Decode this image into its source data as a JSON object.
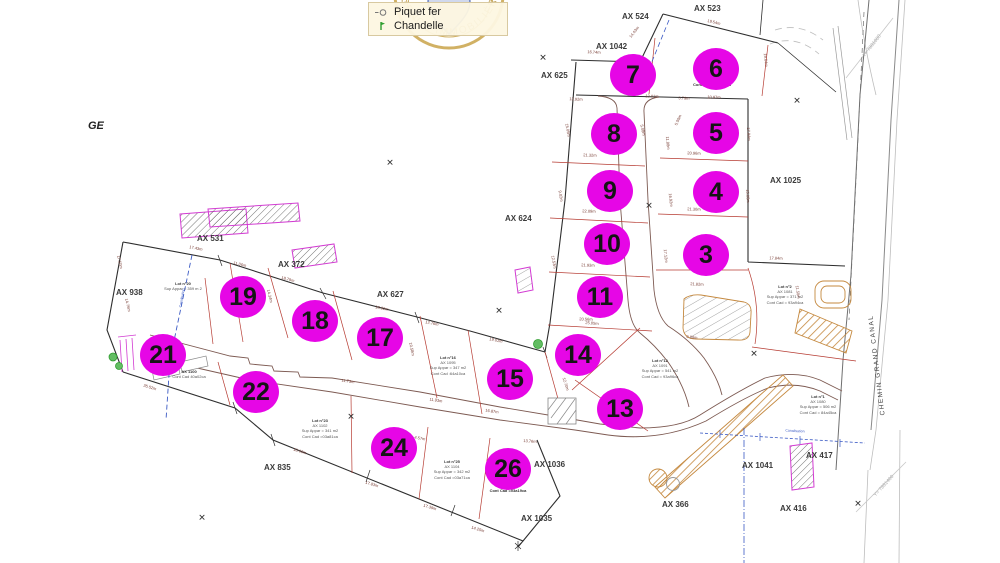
{
  "legend": {
    "items": [
      {
        "icon": "survey-marker-icon",
        "label": "Piquet fer"
      },
      {
        "icon": "pin-icon",
        "label": "Chandelle"
      }
    ]
  },
  "stamp": {
    "text": "AGENCE IMMOBILIÈRE"
  },
  "map": {
    "zone_label": "GE",
    "road_name": "CHEMIN GRAND CANAL",
    "grid_labels": [
      "Y= 7881000",
      "Y= 7881400"
    ],
    "pipe_label": "Canalisation",
    "x_mark": "✕"
  },
  "colors": {
    "lot_marker": "#e606e6",
    "boundary": "#2e2e2e",
    "division": "#b63b32",
    "sidewalk_hatch": "#c5893f",
    "pipe_blue": "#3b5ac4",
    "tree_green": "#2f9e2f"
  },
  "parcel_labels": [
    "AX 524",
    "AX 523",
    "AX 1042",
    "AX 625",
    "AX 624",
    "AX 1025",
    "AX 531",
    "AX 372",
    "AX 938",
    "AX 627",
    "AX 835",
    "AX 1036",
    "AX 1035",
    "AX 366",
    "AX 416",
    "AX 1041",
    "AX 417"
  ],
  "lot_badges": [
    "7",
    "6",
    "8",
    "5",
    "9",
    "4",
    "10",
    "3",
    "11",
    "14",
    "15",
    "13",
    "17",
    "18",
    "19",
    "21",
    "22",
    "24",
    "26"
  ],
  "lot_notes": [
    {
      "lines": [
        "Lot n°20",
        "Sup Appar = 359 m 2"
      ]
    },
    {
      "lines": [
        "AX 1100",
        "Cont Cad 40a02ca"
      ]
    },
    {
      "lines": [
        "Lot n°16",
        "AX 1095",
        "Sup Appar = 347 m2",
        "Cont Cad :64a10ca"
      ]
    },
    {
      "lines": [
        "Lot n°12",
        "AX 1091",
        "Sup Appar = 541 m2",
        "Cont Cad = 93a96ca"
      ]
    },
    {
      "lines": [
        "Lot n°2",
        "AX 1081",
        "Sup Appar = 371 m2",
        "Cont Cad = 93a94ca"
      ]
    },
    {
      "lines": [
        "Lot n°1",
        "AX 1080",
        "Sup Appar = 506 m2",
        "Cont Cad = 84a45ca"
      ]
    },
    {
      "lines": [
        "Lot n°25",
        "AX 1104",
        "Sup Appar = 342 m2",
        "Cont Cad =03a71ca"
      ]
    },
    {
      "lines": [
        "Cont Cad =03a19ca"
      ]
    },
    {
      "lines": [
        "Cont Cad = 02a60ca"
      ]
    },
    {
      "lines": [
        "Lot n°23",
        "AX 1102",
        "Sup Appar = 341 m2",
        "Cont Cad =03a81ca"
      ]
    }
  ],
  "measures": [
    "16.74m",
    "13.92m",
    "13.01m",
    "3.79m",
    "10.97m",
    "19.54m",
    "14.43m",
    "19.64m",
    "21.32m",
    "22.09m",
    "21.93m",
    "20.56m",
    "20.96m",
    "21.30m",
    "21.82m",
    "17.84m",
    "15.08m",
    "11.88m",
    "16.92m",
    "17.12m",
    "17.84m",
    "15.05m",
    "9.02m",
    "12.53m",
    "17.43m",
    "11.06m",
    "18.79m",
    "18.92m",
    "12.76m",
    "19.01m",
    "14.34m",
    "10.58m",
    "11.73m",
    "11.93m",
    "16.87m",
    "13.76m",
    "4.57m",
    "2.93m",
    "17.50m",
    "14.76m",
    "35.52m",
    "18.06m",
    "17.83m",
    "17.39m",
    "14.25m",
    "23.37m",
    "25.05m",
    "14.92m",
    "12.70m",
    "9.88m",
    "11.50m",
    "5.00m",
    "5.08m"
  ]
}
